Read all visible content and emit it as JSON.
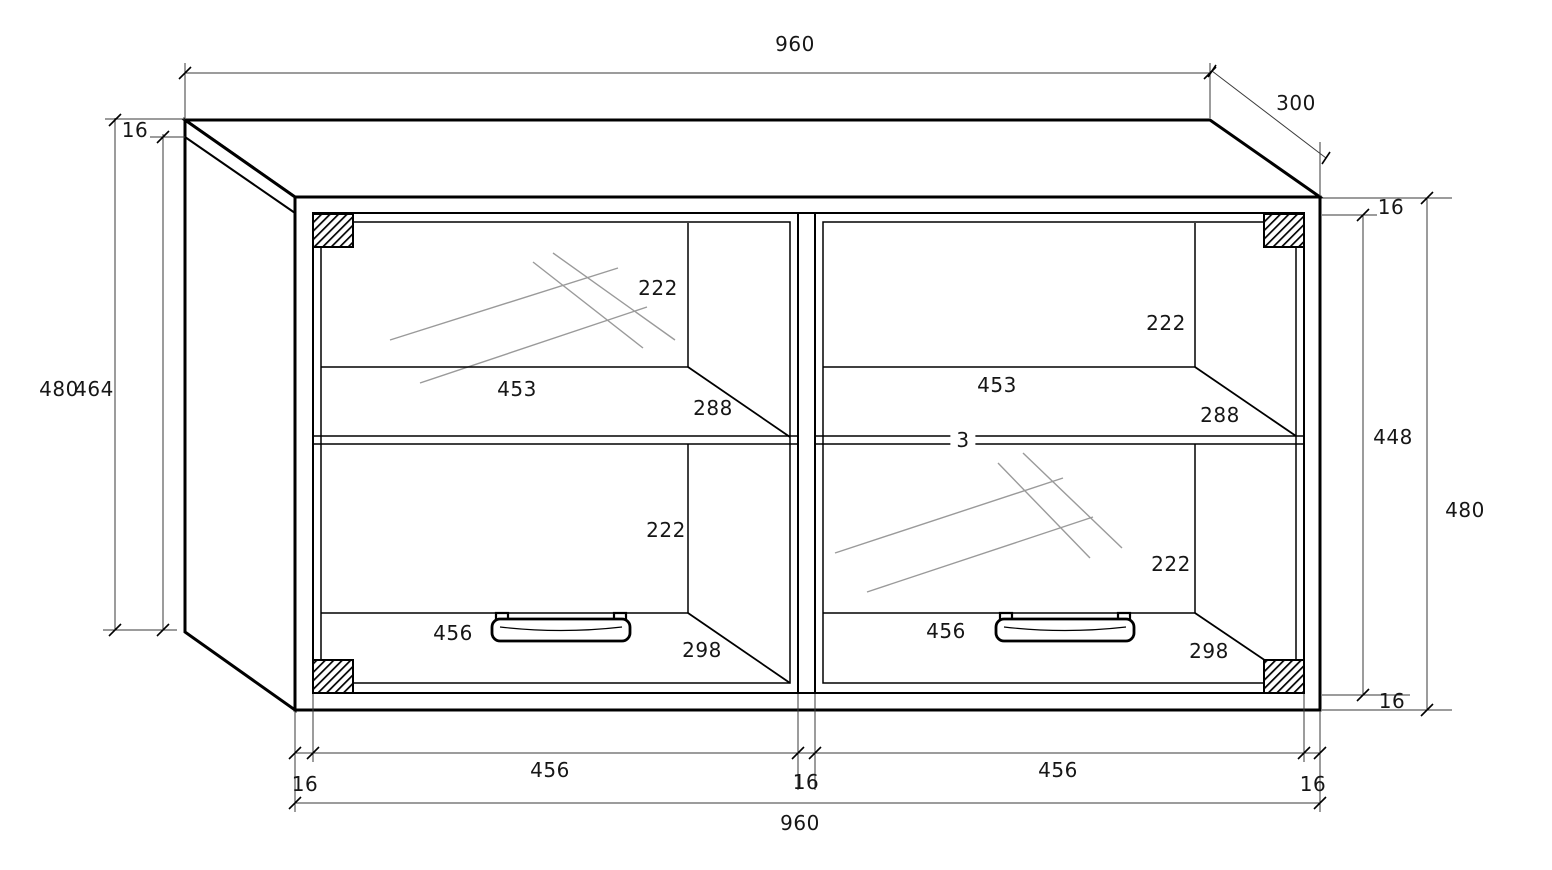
{
  "drawing": {
    "type": "furniture technical drawing",
    "subject": "wall-hung two-door glass display cabinet, dimensioned oblique projection"
  },
  "dimensions": {
    "overall_width": "960",
    "depth": "300",
    "panel_thickness": "16",
    "overall_height": "480",
    "left_inner_height": "464",
    "right_inner_height": "448",
    "compartment_height": "222",
    "shelf_width": "453",
    "shelf_depth": "288",
    "shelf_thickness": "3",
    "door_width": "456",
    "bottom_depth": "298"
  }
}
